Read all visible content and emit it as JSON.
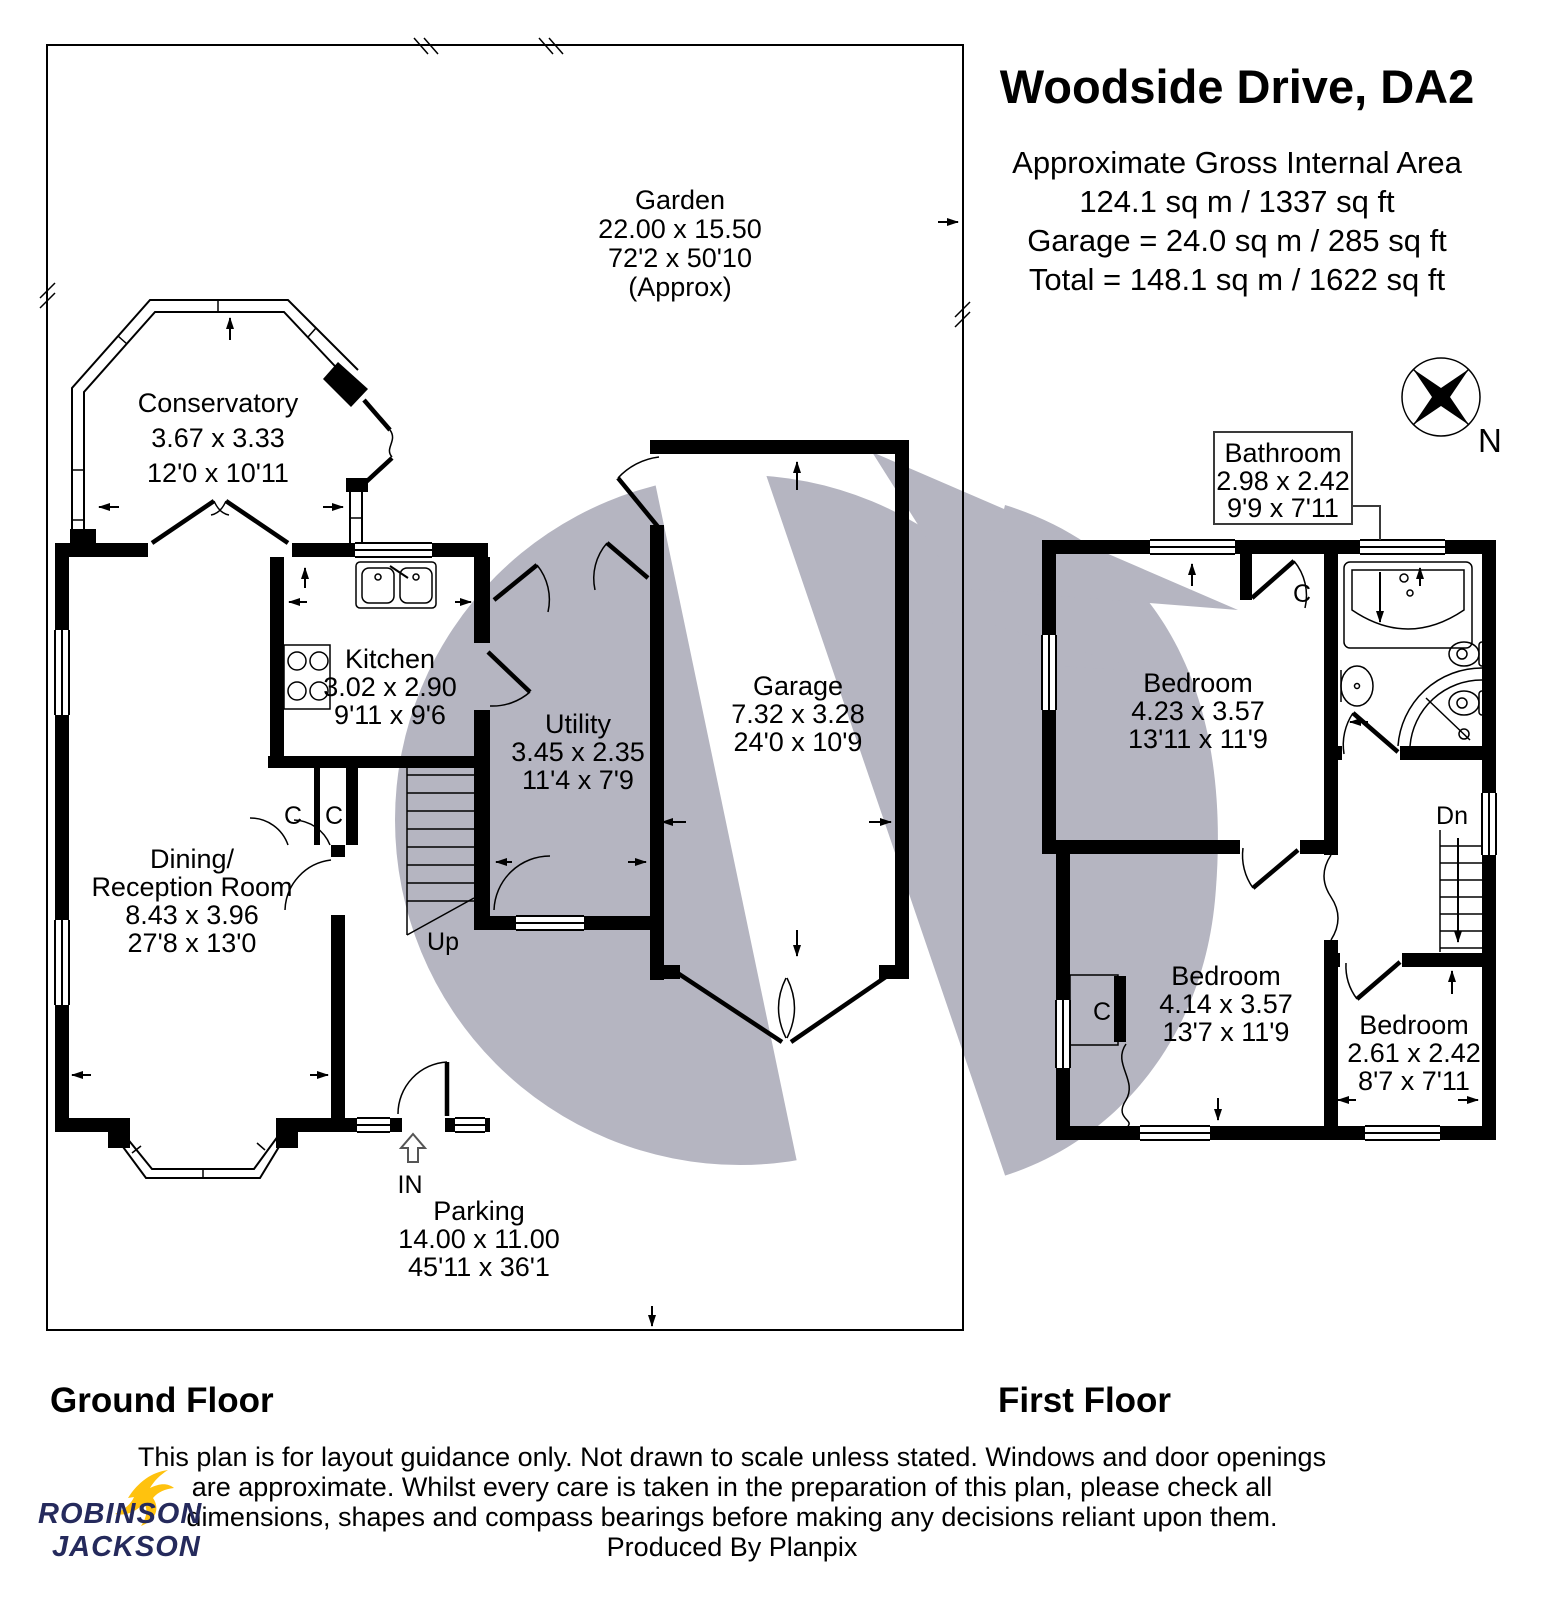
{
  "header": {
    "title": "Woodside Drive, DA2",
    "area_lines": [
      "Approximate Gross Internal Area",
      "124.1 sq m / 1337 sq ft",
      "Garage = 24.0 sq m / 285 sq ft",
      "Total = 148.1 sq m / 1622 sq ft"
    ]
  },
  "compass": {
    "label": "N"
  },
  "ground_floor": {
    "label": "Ground Floor",
    "garden": {
      "name": "Garden",
      "metric": "22.00 x 15.50",
      "imperial": "72'2 x 50'10",
      "approx": "(Approx)"
    },
    "conservatory": {
      "name": "Conservatory",
      "metric": "3.67 x 3.33",
      "imperial": "12'0 x 10'11"
    },
    "kitchen": {
      "name": "Kitchen",
      "metric": "3.02 x 2.90",
      "imperial": "9'11 x 9'6"
    },
    "utility": {
      "name": "Utility",
      "metric": "3.45 x 2.35",
      "imperial": "11'4 x 7'9"
    },
    "garage": {
      "name": "Garage",
      "metric": "7.32 x 3.28",
      "imperial": "24'0 x 10'9"
    },
    "dining": {
      "name1": "Dining/",
      "name2": "Reception Room",
      "metric": "8.43 x 3.96",
      "imperial": "27'8 x 13'0"
    },
    "parking": {
      "name": "Parking",
      "metric": "14.00 x 11.00",
      "imperial": "45'11 x 36'1"
    },
    "stairs_label": "Up",
    "entrance_label": "IN",
    "closet": "C"
  },
  "first_floor": {
    "label": "First Floor",
    "bathroom": {
      "name": "Bathroom",
      "metric": "2.98 x 2.42",
      "imperial": "9'9 x 7'11"
    },
    "bedroom1": {
      "name": "Bedroom",
      "metric": "4.23 x 3.57",
      "imperial": "13'11 x 11'9"
    },
    "bedroom2": {
      "name": "Bedroom",
      "metric": "4.14 x 3.57",
      "imperial": "13'7 x 11'9"
    },
    "bedroom3": {
      "name": "Bedroom",
      "metric": "2.61 x 2.42",
      "imperial": "8'7 x 7'11"
    },
    "stairs_label": "Dn",
    "closet": "C"
  },
  "footer": {
    "disclaimer": [
      "This plan is for layout guidance only. Not drawn to scale unless stated. Windows and door openings",
      "are approximate. Whilst every care is taken in the preparation of this plan, please check all",
      "dimensions, shapes and compass bearings before making any decisions reliant upon them.",
      "Produced By Planpix"
    ],
    "brand": {
      "line1": "ROBINSON",
      "line2": "JACKSON"
    }
  },
  "colors": {
    "wall": "#000000",
    "watermark": "#b5b5c1",
    "brand_navy": "#252a5c",
    "brand_yellow": "#ffc20e"
  }
}
